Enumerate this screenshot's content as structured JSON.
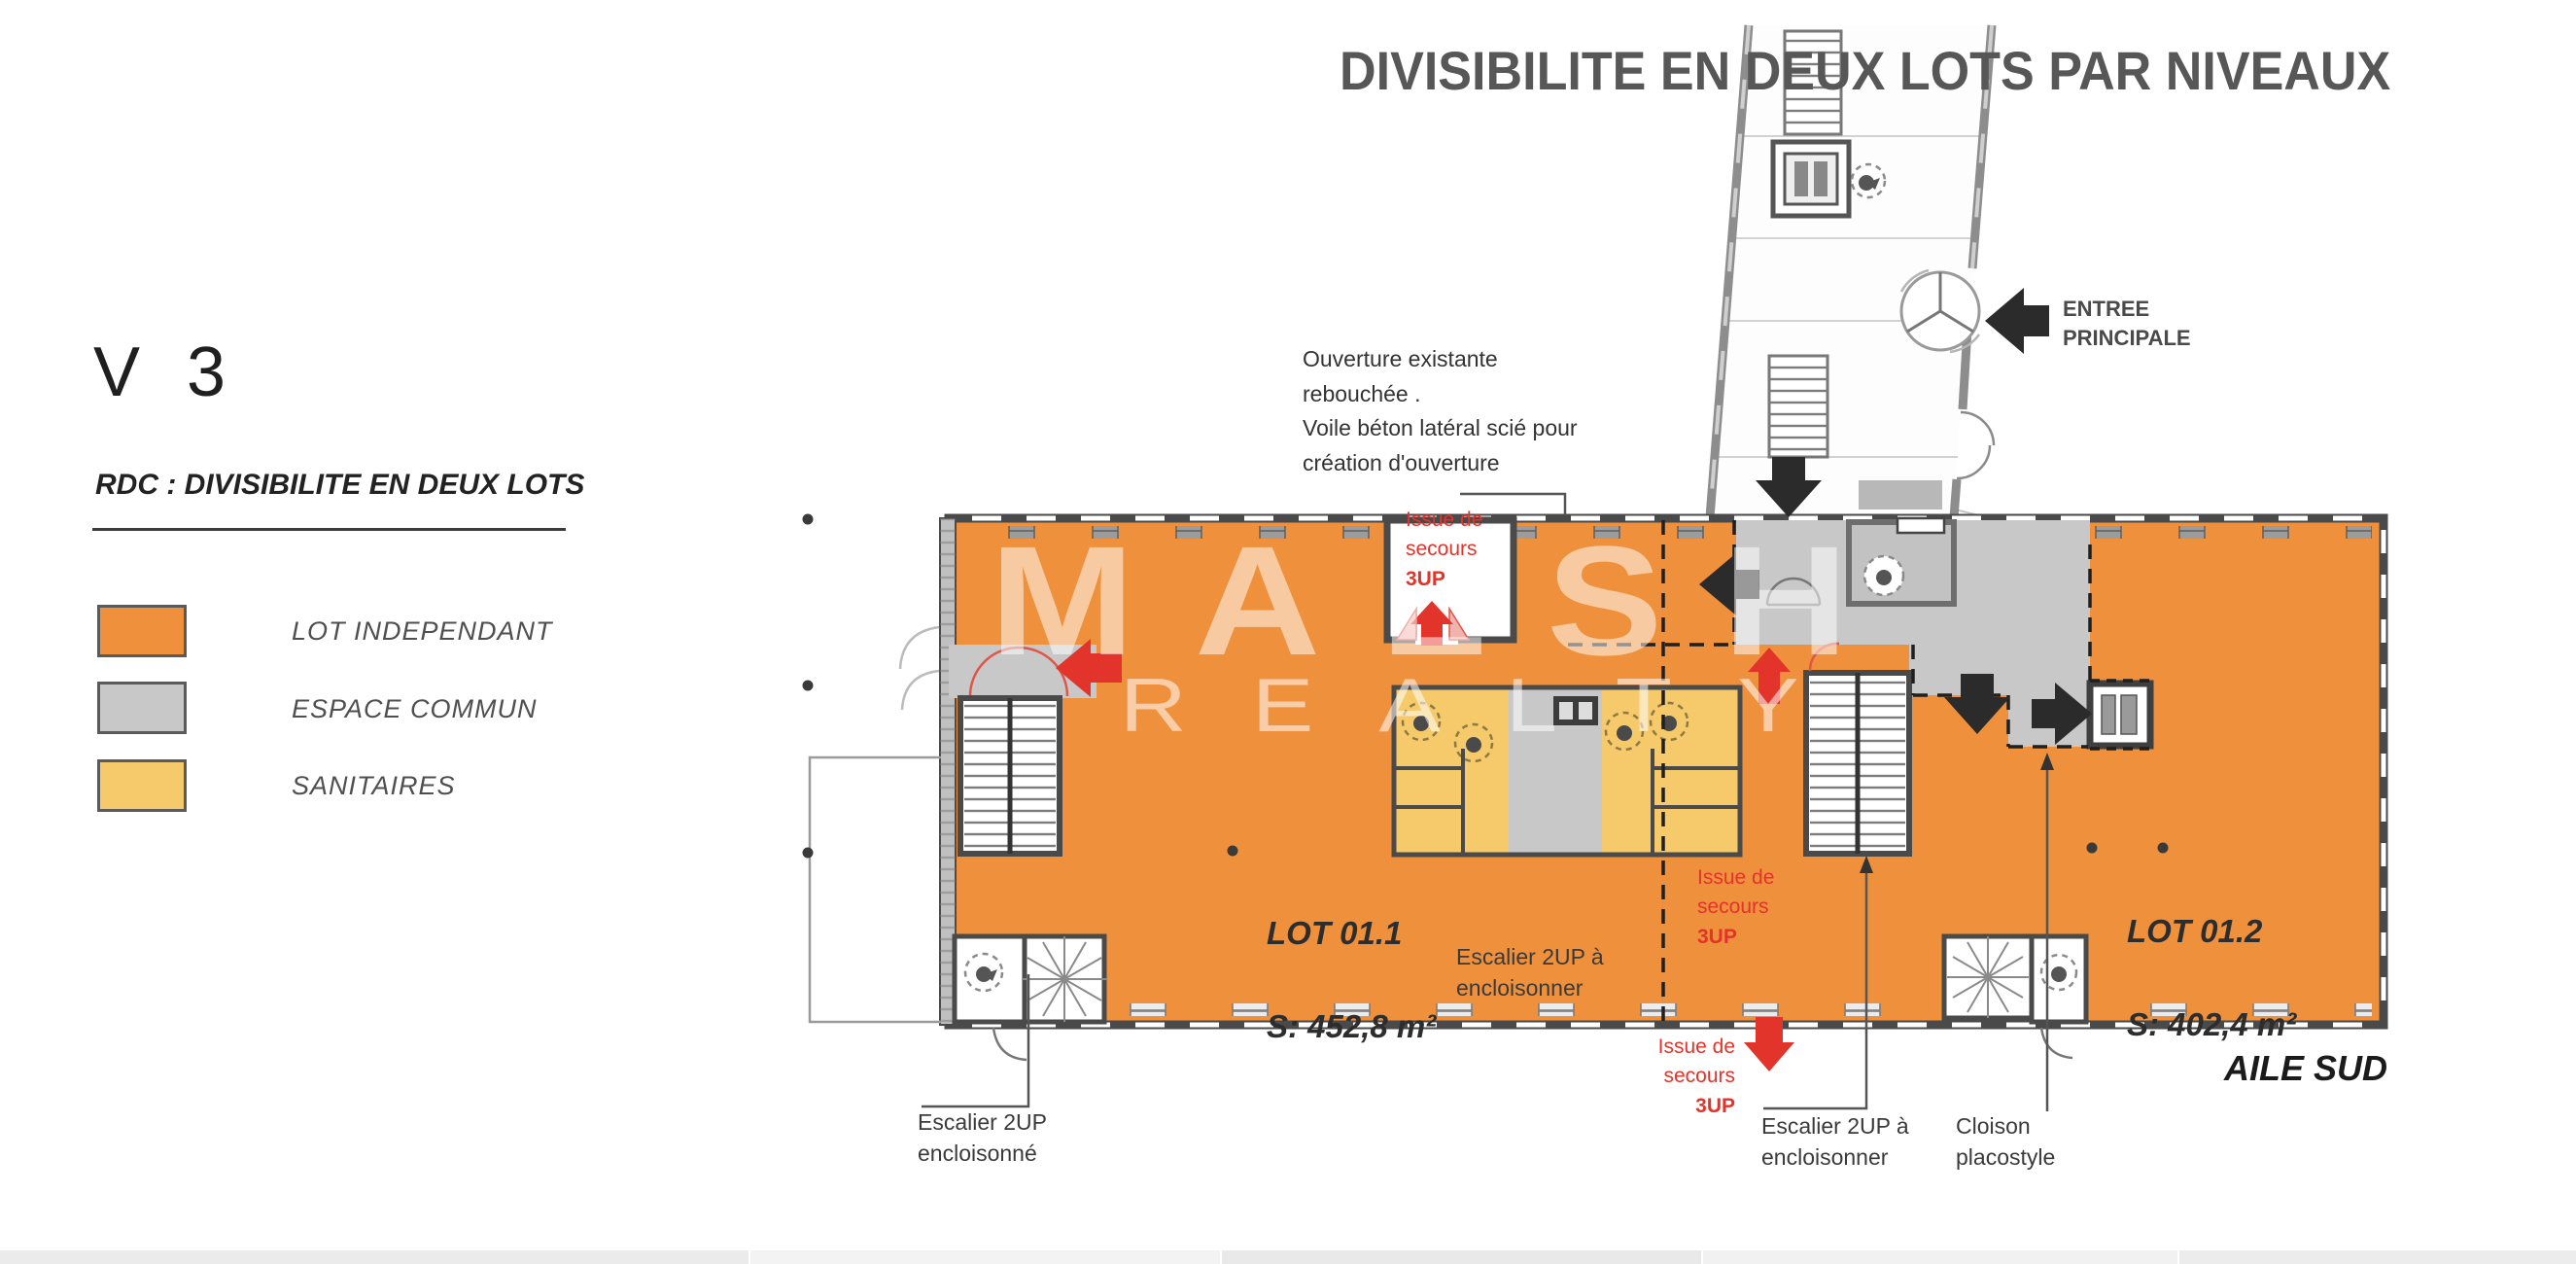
{
  "title": "DIVISIBILITE EN DEUX LOTS PAR NIVEAUX",
  "sidebar": {
    "version": "V 3",
    "heading": "RDC : DIVISIBILITE EN DEUX LOTS",
    "legend": [
      {
        "label": "LOT INDEPENDANT",
        "color": "#EF913C"
      },
      {
        "label": "ESPACE COMMUN",
        "color": "#C8C8C8"
      },
      {
        "label": "SANITAIRES",
        "color": "#F6C96A"
      }
    ]
  },
  "watermark": {
    "name": "MALSH",
    "subname": "REALTY"
  },
  "notes": {
    "ouverture": "Ouverture existante\nrebouchée .\nVoile béton latéral scié pour\ncréation d'ouverture",
    "entree": "ENTREE\nPRINCIPALE",
    "issue_lines": "Issue de\nsecours",
    "issue_up": "3UP",
    "escalier_a_encloisonner": "Escalier 2UP à\nencloisonner",
    "escalier_encloisonne": "Escalier 2UP\nencloisonné",
    "cloison": "Cloison\nplacostyle",
    "aile": "AILE SUD"
  },
  "lots": [
    {
      "name": "LOT 01.1",
      "area": "S: 452,8 m²"
    },
    {
      "name": "LOT 01.2",
      "area": "S: 402,4 m²"
    }
  ],
  "colors": {
    "lot_fill": "#EF913C",
    "common_fill": "#C8C8C8",
    "sanitary_fill": "#F6C96A",
    "exit_red": "#E3342B",
    "wall": "#4A4A4A",
    "title_gray": "#575757"
  }
}
